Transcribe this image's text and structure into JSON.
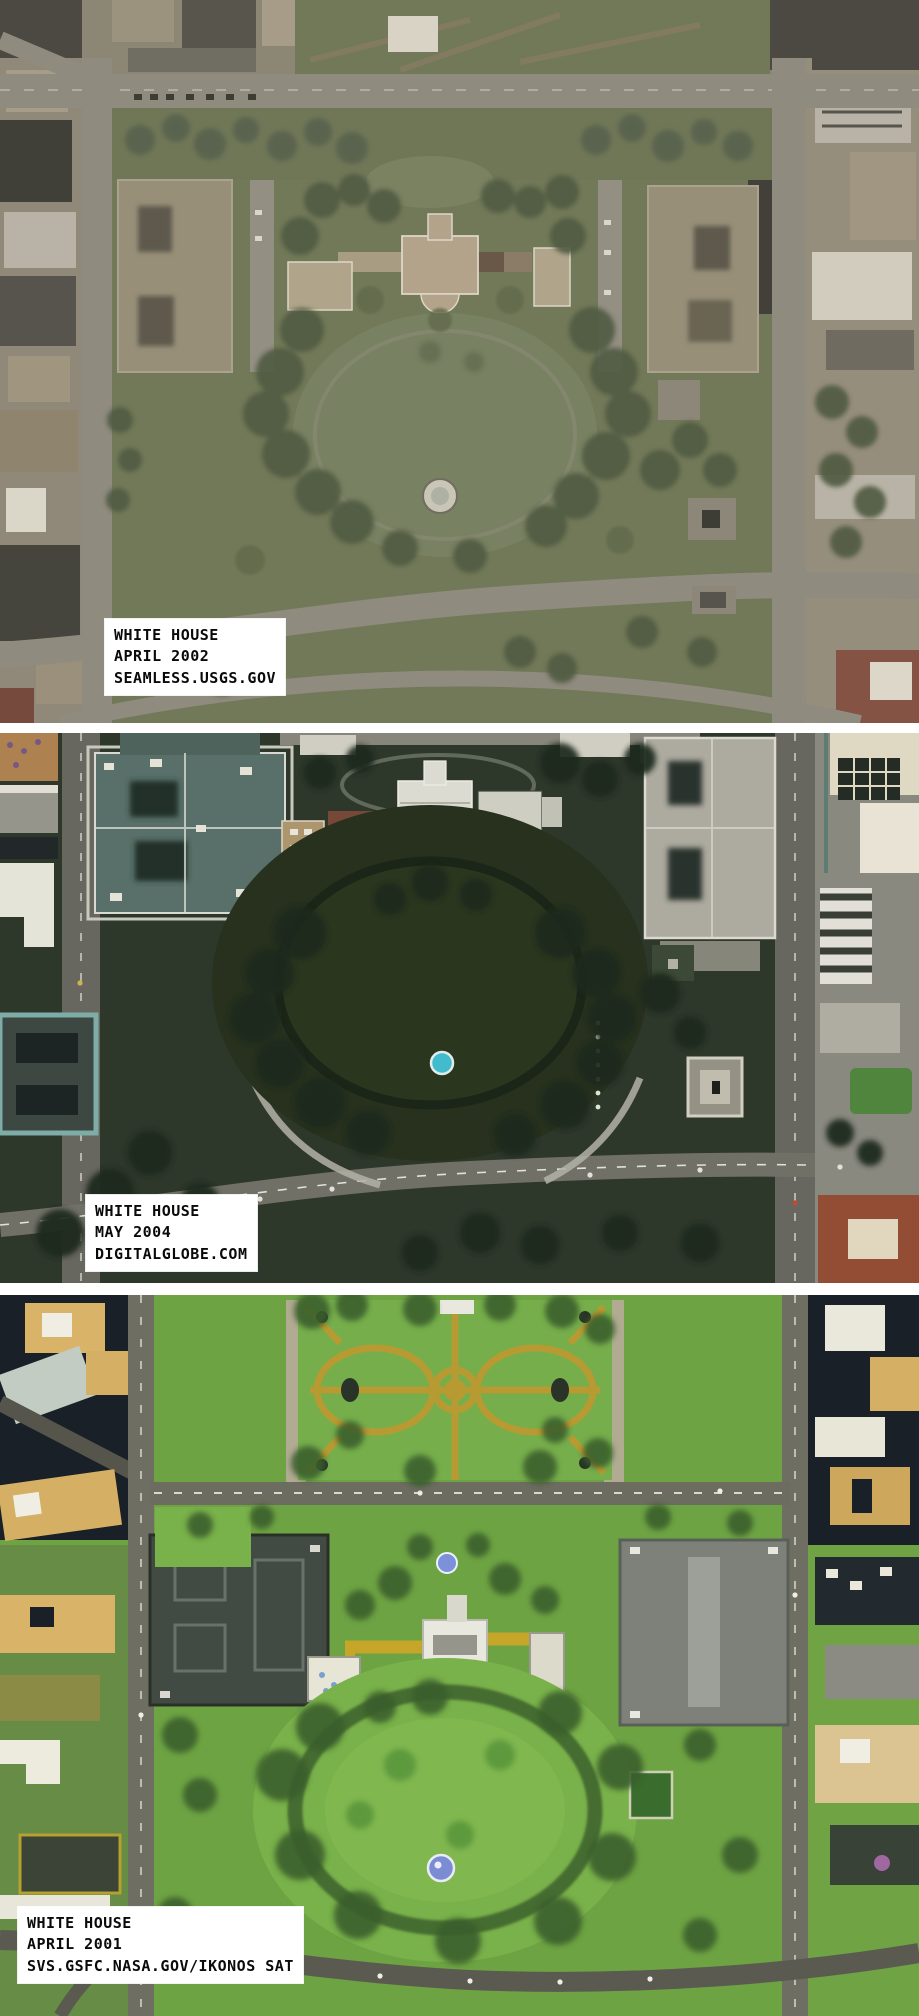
{
  "page": {
    "title": "White House satellite imagery comparison",
    "background_color": "#ffffff"
  },
  "panels": [
    {
      "id": "panel-2002",
      "source_label": {
        "line1": "WHITE HOUSE",
        "line2": "APRIL 2002",
        "line3": "SEAMLESS.USGS.GOV"
      },
      "palette": {
        "ground": "#6e7951",
        "trees": "#4e5b3d",
        "roads": "#8d897b",
        "white_house_roof": "#b3a183",
        "government_building": "#978d73",
        "red_roof": "#8e4f3c",
        "fountain": "#c7c4b4"
      }
    },
    {
      "id": "panel-2004",
      "source_label": {
        "line1": "WHITE HOUSE",
        "line2": "MAY 2004",
        "line3": "DIGITALGLOBE.COM"
      },
      "palette": {
        "ground": "#2e392b",
        "trees": "#1f2a1d",
        "roads": "#75746a",
        "white_house_roof": "#e2e2d8",
        "eeob_roof": "#5a746c",
        "treasury_roof": "#b2afa3",
        "fountain": "#3fc3d6",
        "pool": "#49c2d4",
        "red_roof": "#9c4f35"
      }
    },
    {
      "id": "panel-2001",
      "source_label": {
        "line1": "WHITE HOUSE",
        "line2": "APRIL 2001",
        "line3": "SVS.GSFC.NASA.GOV/IKONOS SAT"
      },
      "palette": {
        "ground": "#73a04f",
        "lawn": "#7fae57",
        "trees": "#3c5c30",
        "roads": "#6c6c62",
        "park_paths": "#b29a42",
        "white_house_roof": "#e9e8e0",
        "eeob_roof": "#424a44",
        "treasury_roof": "#7d817a",
        "fountain": "#7f8cc8",
        "city_buildings": "#d0b070"
      }
    }
  ]
}
